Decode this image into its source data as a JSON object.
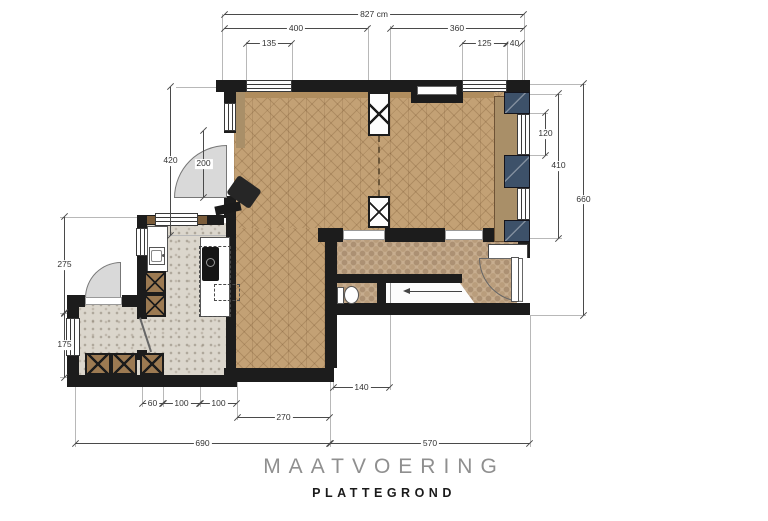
{
  "title": {
    "main": "MAATVOERING",
    "sub": "PLATTEGROND"
  },
  "dims": {
    "total_width": "827 cm",
    "top_left": "400",
    "top_right": "360",
    "win_left": "135",
    "win_right": "125",
    "pier_right": "40",
    "left_upper": "420",
    "door_opening": "200",
    "left_mid": "275",
    "left_lower": "175",
    "right_window": "120",
    "right_upper": "410",
    "right_total": "660",
    "toilet_width": "140",
    "cab_60": "60",
    "cab_100a": "100",
    "cab_100b": "100",
    "room_270": "270",
    "total_690": "690",
    "total_570": "570"
  },
  "colors": {
    "wall": "#1c1c1c",
    "wood_floor": "#c3a175",
    "mosaic_floor": "#c7ad8f",
    "terrazzo_floor": "#dbd6cc",
    "navy_pier": "#3d5169",
    "cabinet_wood": "#9c7a52",
    "dimension_line": "#4a4a4a",
    "door_swing": "#d9d9d9"
  },
  "icons": {
    "stairs_direction": "left-arrow",
    "toilet": "wc-bowl",
    "doors": "quarter-arc-swing",
    "cabinets": "x-cross",
    "sliding_door": "dashed-line"
  }
}
